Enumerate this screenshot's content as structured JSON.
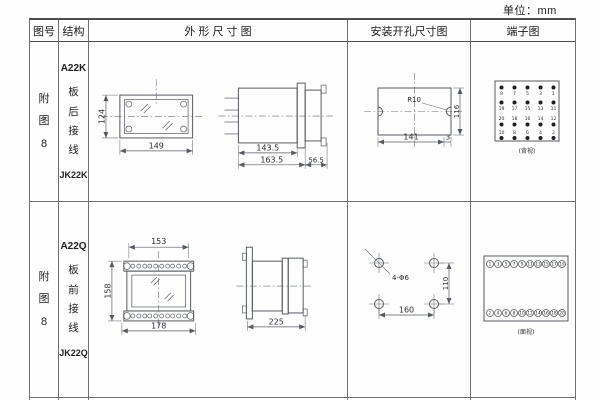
{
  "unit_label": "单位：mm",
  "header": {
    "fig_no": "图号",
    "structure": "结构",
    "outline": "外 形 尺 寸 图",
    "mounting": "安装开孔尺寸图",
    "terminal": "端子图"
  },
  "row1": {
    "fig_no": "附图8",
    "model": "A22K",
    "wiring": "板后接线",
    "relay": "JK22K",
    "dims": {
      "front_h": "124",
      "front_w": "149",
      "side_d1": "143.5",
      "side_d2": "163.5",
      "side_d3": "56.5"
    },
    "mount": {
      "r": "R10",
      "w": "141",
      "h": "116",
      "edge": "3"
    },
    "term": {
      "r1": [
        "9",
        "7",
        "5",
        "3",
        "1"
      ],
      "r2": [
        "19",
        "17",
        "15",
        "13",
        "11"
      ],
      "r3": [
        "20",
        "18",
        "16",
        "14",
        "12"
      ],
      "r4": [
        "10",
        "8",
        "6",
        "4",
        "2"
      ],
      "caption": "(背视)"
    }
  },
  "row2": {
    "fig_no": "附图8",
    "model": "A22Q",
    "wiring": "板前接线",
    "relay": "JK22Q",
    "dims": {
      "front_top": "153",
      "front_h": "158",
      "front_bottom": "178",
      "side_len": "225"
    },
    "mount": {
      "holes": "4-Φ6",
      "w": "160",
      "h": "110"
    },
    "term": {
      "top": [
        "1",
        "3",
        "5",
        "7",
        "9",
        "11",
        "13",
        "15",
        "17",
        "19"
      ],
      "bottom": [
        "2",
        "4",
        "6",
        "8",
        "10",
        "12",
        "14",
        "16",
        "18",
        "20"
      ],
      "caption": "(面视)"
    }
  }
}
